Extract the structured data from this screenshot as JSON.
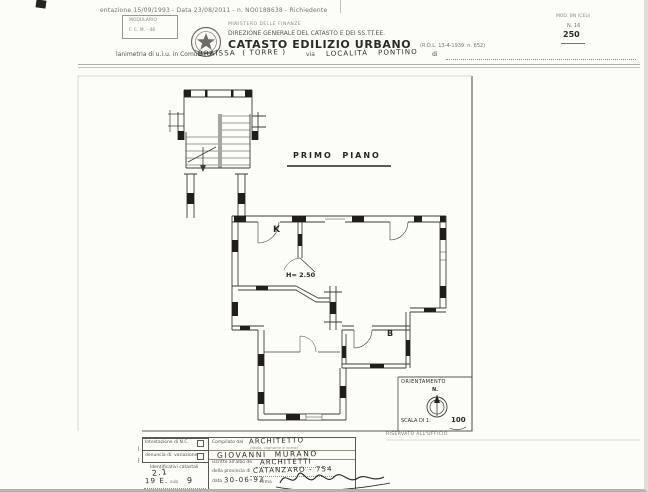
{
  "scan": {
    "top_line": "entazione 15/09/1993 - Data 23/08/2011 - n. NO0188638 - Richiedente",
    "modulario": {
      "l1": "MODULARIO",
      "l2": "F. C. M. - 46"
    },
    "header": {
      "ministero": "MINISTERO DELLE FINANZE",
      "direzione": "DIREZIONE GENERALE DEL CATASTO E DEI SS.TT.EE.",
      "title": "CATASTO EDILIZIO URBANO",
      "title_ref": "(R.D.L. 13-4-1939  n. 652)"
    },
    "mod_box": {
      "l1": "MOD. BN (CEU)",
      "l2": "N. 16",
      "l3": "250"
    },
    "plan_line": {
      "prefix": "lanimetria di u.i.u. in Comune di",
      "comune": "BRAISSA  ( TORRE )",
      "via": "via",
      "localita": "LOCALITÀ   PONTINO",
      "suffix": "di"
    }
  },
  "plan": {
    "floor": "PRIMO  PIANO",
    "labels": {
      "k": "K",
      "h": "H= 2.50",
      "b": "B"
    },
    "orientation": {
      "title": "ORIENTAMENTO",
      "n": "N.",
      "scala": "SCALA DI 1:",
      "scala_val": "100"
    },
    "reserved": "RISERVATO ALL'UFFICIO"
  },
  "form": {
    "left": {
      "r1": "Intestazione di N.C.",
      "r2": "denuncia di: variazione",
      "ids": "Identificativi catastali",
      "h1": "2.1",
      "h2": "19 E.",
      "sub": "sub",
      "h3": "9"
    },
    "right": {
      "compilato": "Compilato dal",
      "compilato_v": "ARCHITETTO",
      "hint": "(titolo, cognome e nome)",
      "nome": "GIOVANNI  MURANO",
      "albo": "iscritto all'albo de",
      "albo_v": "ARCHITETTI",
      "prov": "della provincia di",
      "prov_v": "CATANZARO - 754",
      "data": "data",
      "data_v": "30-06-93",
      "firma": "firma"
    }
  }
}
